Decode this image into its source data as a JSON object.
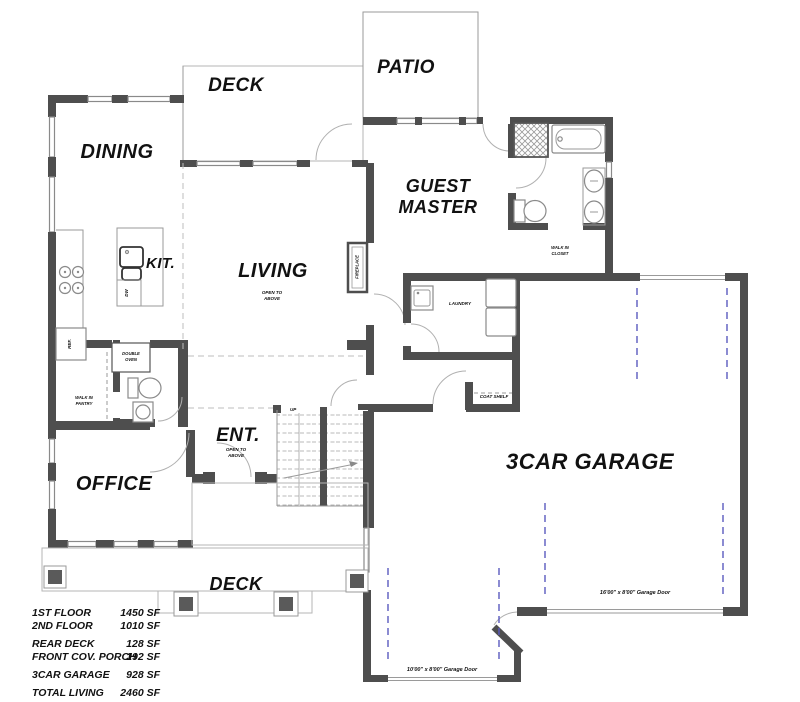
{
  "plan": {
    "rooms": {
      "deck_rear": "DECK",
      "patio": "PATIO",
      "dining": "DINING",
      "guest_master_line1": "GUEST",
      "guest_master_line2": "MASTER",
      "kitchen": "KIT.",
      "living": "LIVING",
      "office": "OFFICE",
      "entry": "ENT.",
      "laundry": "LAUNDRY",
      "garage": "3CAR GARAGE",
      "deck_front": "DECK"
    },
    "annotations": {
      "open_to": "OPEN TO",
      "above": "ABOVE",
      "fireplace": "FIREPLACE",
      "ref": "REF.",
      "dw": "DW",
      "double_oven_line1": "DOUBLE",
      "double_oven_line2": "OVEN",
      "pantry_line1": "WALK IN",
      "pantry_line2": "PANTRY",
      "closet_line1": "WALK IN",
      "closet_line2": "CLOSET",
      "coat_shelf": "COAT SHELF",
      "up": "UP",
      "garage_door_16": "16'00\" x 8'00\" Garage Door",
      "garage_door_10": "10'00\" x 8'00\" Garage Door"
    },
    "areas": {
      "rows": [
        {
          "label": "1ST FLOOR",
          "value": "1450 SF"
        },
        {
          "label": "2ND FLOOR",
          "value": "1010 SF"
        },
        {
          "label": "REAR DECK",
          "value": "128 SF"
        },
        {
          "label": "FRONT COV. PORCH",
          "value": "192 SF"
        },
        {
          "label": "3CAR GARAGE",
          "value": "928 SF"
        },
        {
          "label": "TOTAL LIVING",
          "value": "2460 SF"
        }
      ]
    }
  }
}
